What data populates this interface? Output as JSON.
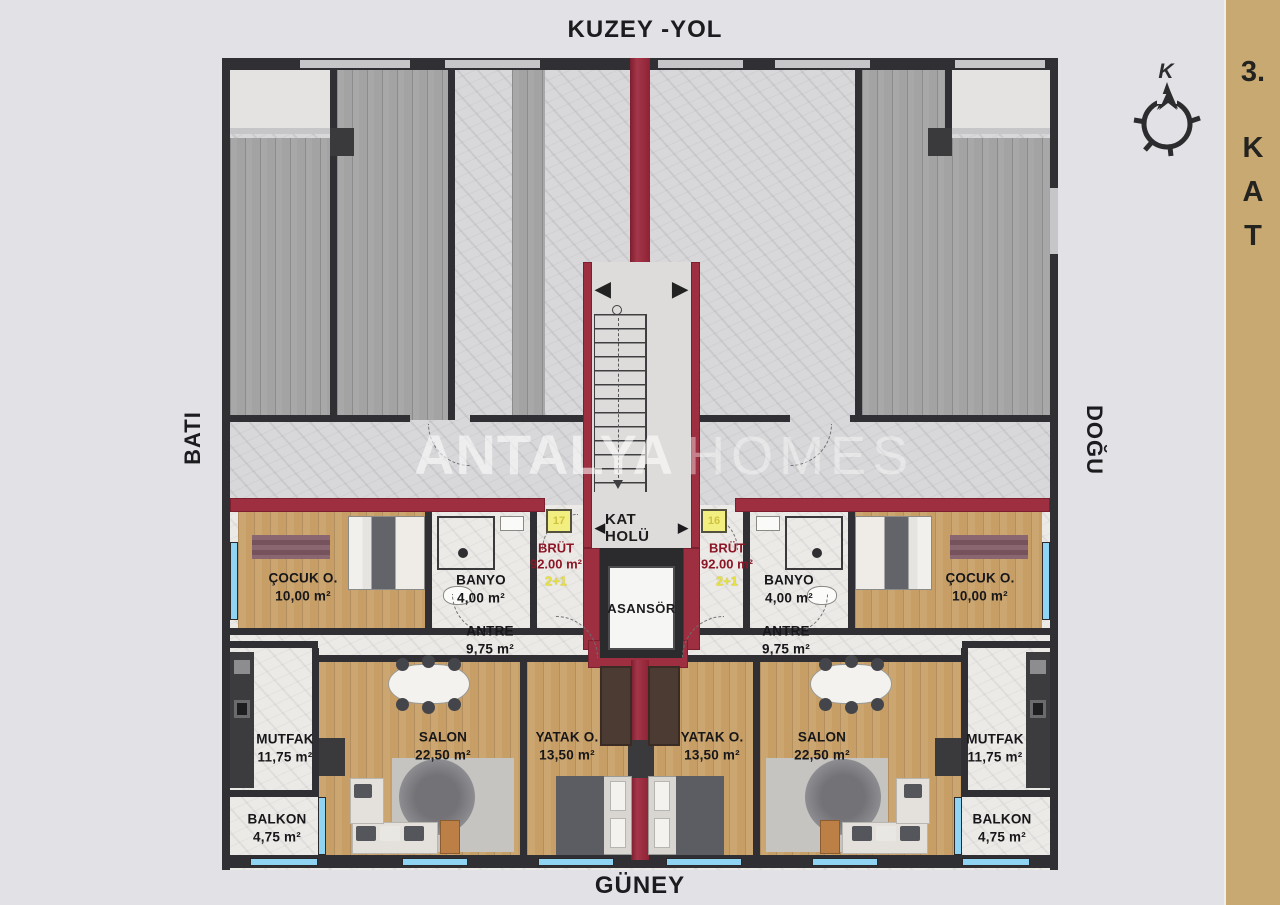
{
  "directions": {
    "north": "KUZEY -YOL",
    "south": "GÜNEY",
    "west": "BATI",
    "east": "DOĞU"
  },
  "floor_tab": {
    "number": "3.",
    "letters": [
      "K",
      "A",
      "T"
    ]
  },
  "compass": {
    "north_letter": "K"
  },
  "watermark": {
    "brand_bold": "ANTALYA",
    "brand_light": "HOMES"
  },
  "core": {
    "hall_label": "KAT HOLÜ",
    "left_arrow": "◀",
    "right_arrow": "▶",
    "elevator_label": "ASANSÖR"
  },
  "units": {
    "left": {
      "door_no": "17",
      "brut_label": "BRÜT",
      "brut_area": "92.00 m²",
      "plan_type": "2+1",
      "rooms": [
        {
          "name": "ÇOCUK O.",
          "area": "10,00 m²"
        },
        {
          "name": "BANYO",
          "area": "4,00 m²"
        },
        {
          "name": "ANTRE",
          "area": "9,75 m²"
        },
        {
          "name": "MUTFAK",
          "area": "11,75 m²"
        },
        {
          "name": "SALON",
          "area": "22,50 m²"
        },
        {
          "name": "YATAK O.",
          "area": "13,50 m²"
        },
        {
          "name": "BALKON",
          "area": "4,75 m²"
        }
      ]
    },
    "right": {
      "door_no": "16",
      "brut_label": "BRÜT",
      "brut_area": "92.00 m²",
      "plan_type": "2+1",
      "rooms": [
        {
          "name": "ÇOCUK O.",
          "area": "10,00 m²"
        },
        {
          "name": "BANYO",
          "area": "4,00 m²"
        },
        {
          "name": "ANTRE",
          "area": "9,75 m²"
        },
        {
          "name": "MUTFAK",
          "area": "11,75 m²"
        },
        {
          "name": "SALON",
          "area": "22,50 m²"
        },
        {
          "name": "YATAK O.",
          "area": "13,50 m²"
        },
        {
          "name": "BALKON",
          "area": "4,75 m²"
        }
      ]
    }
  },
  "colors": {
    "highlight_wall": "#9e2f40",
    "area_text_red": "#8d1626",
    "plan_type_yellow": "#e8e23e",
    "floor_tab_bg": "#c9a972",
    "window_blue": "#8fd4f2",
    "wood_floor": "#c79f66",
    "background": "#e2e1e5"
  }
}
